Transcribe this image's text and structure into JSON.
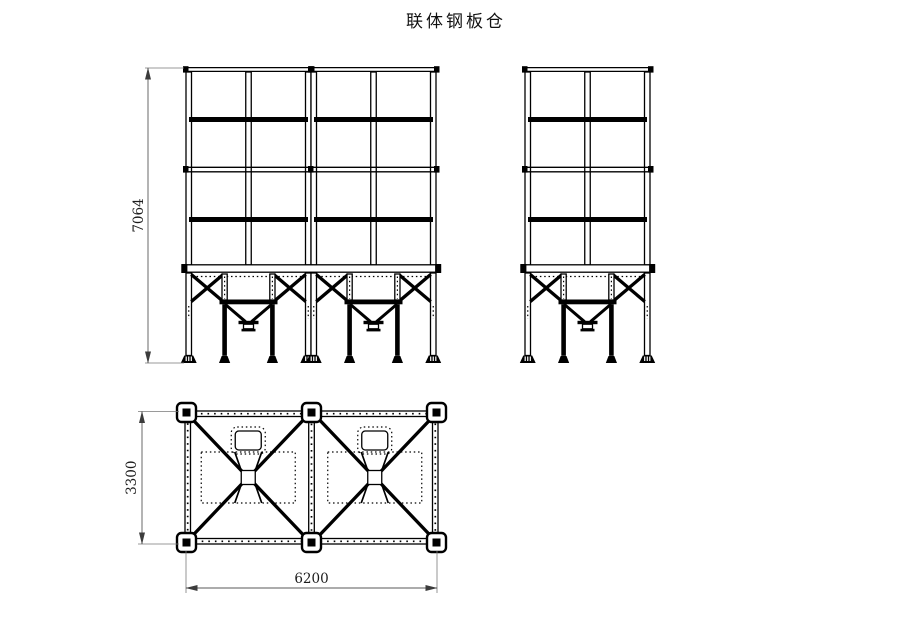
{
  "title": "联体钢板仓",
  "drawing": {
    "background": "#ffffff",
    "line_color": "#000000",
    "dimension_line_color": "#5a5a5a"
  },
  "dimensions": {
    "overall_height": "7064",
    "plan_depth": "3300",
    "plan_width": "6200"
  }
}
